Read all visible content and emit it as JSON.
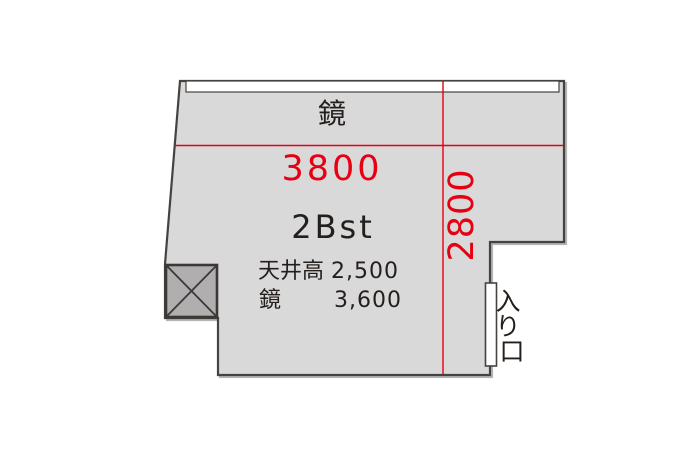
{
  "plan": {
    "mirror_wall_label": "鏡",
    "room_name": "2Bst",
    "dimensions": {
      "width": "3800",
      "depth": "2800"
    },
    "specs": [
      {
        "label": "天井高",
        "value": "2,500"
      },
      {
        "label": "鏡",
        "value": "3,600"
      }
    ],
    "entrance": {
      "label": "入り口",
      "chars": [
        "入",
        "り",
        "口"
      ]
    }
  },
  "colors": {
    "background": "#ffffff",
    "room_fill": "#d9d9d9",
    "wall_stroke": "#46423f",
    "mirror_fill": "#ffffff",
    "column_fill": "#b0aeae",
    "column_stroke": "#3c3835",
    "door_fill": "#ffffff",
    "dimension_red": "#e60012",
    "text_black": "#241f1c"
  }
}
